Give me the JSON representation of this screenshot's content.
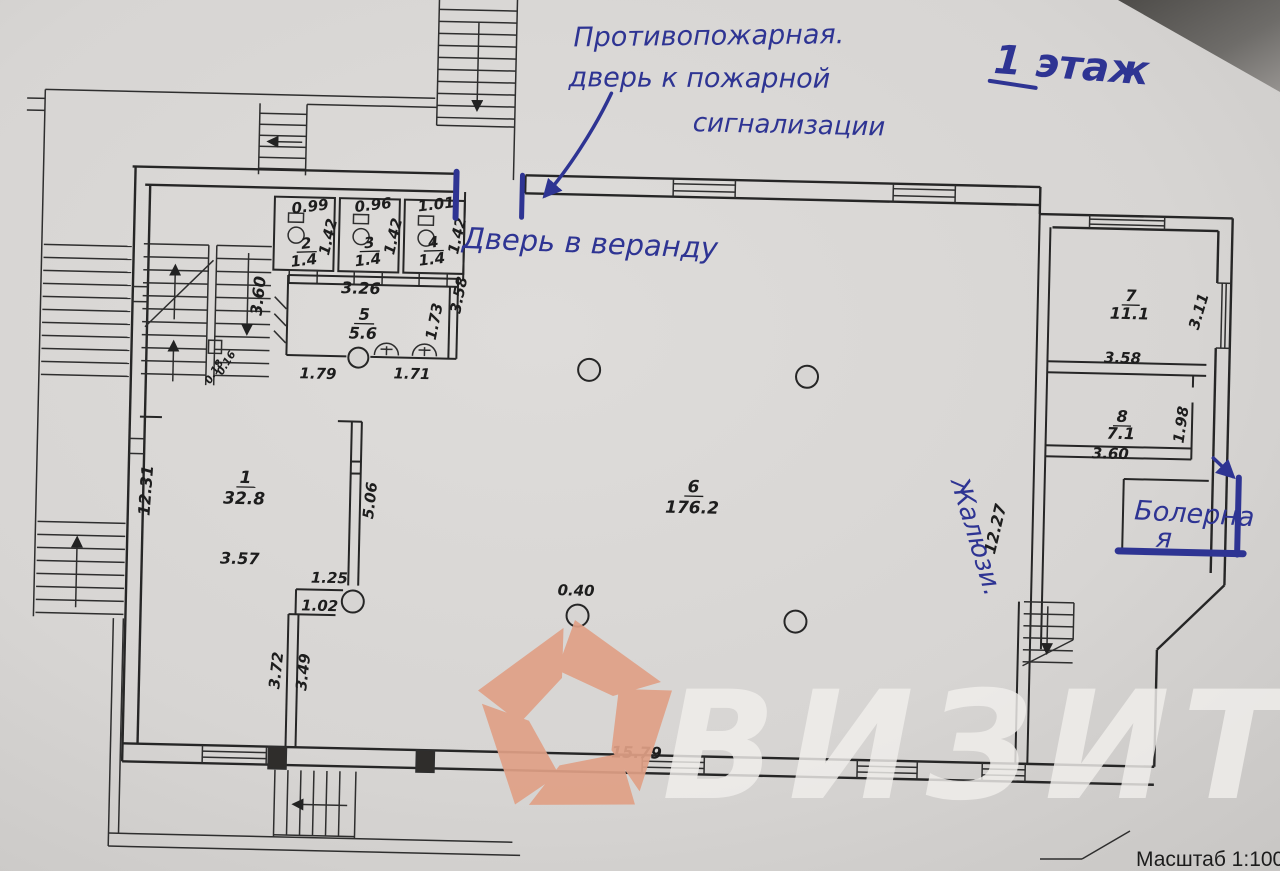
{
  "meta": {
    "floor_title": "1 этаж",
    "scale_label": "Масштаб 1:100"
  },
  "handwritten": {
    "ink_color": "#2e3493",
    "fire_note": [
      "Противопожарная.",
      "дверь к пожарной",
      "сигнализации"
    ],
    "veranda_note": "Дверь в веранду",
    "boiler_note": [
      "Болерна",
      "я"
    ],
    "blinds_note": "Жалюзи."
  },
  "watermark": {
    "brand": "ВИЗИТ",
    "logo_color": "#e0a086",
    "text_color": "#f1efec"
  },
  "rooms": {
    "r1": {
      "num": "1",
      "area": "32.8"
    },
    "r2": {
      "num": "2",
      "area": "1.4"
    },
    "r3": {
      "num": "3",
      "area": "1.4"
    },
    "r4": {
      "num": "4",
      "area": "1.4"
    },
    "r5": {
      "num": "5",
      "area": "5.6"
    },
    "r6": {
      "num": "6",
      "area": "176.2"
    },
    "r7": {
      "num": "7",
      "area": "11.1"
    },
    "r8": {
      "num": "8",
      "area": "7.1"
    }
  },
  "dims": {
    "w2": "0.99",
    "w3": "0.96",
    "w4": "1.01",
    "stall_depth": "1.42",
    "room5_top": "3.26",
    "room5_right": "1.73",
    "corridor_right": "3.58",
    "room5_b_left": "1.79",
    "room5_b_right": "1.71",
    "stair_width": "3.60",
    "col_a": "0.18",
    "col_b": "0.16",
    "left_len": "12.31",
    "room1_w": "3.57",
    "hall_left": "5.06",
    "niche_a": "1.25",
    "niche_b": "1.02",
    "column_d": "0.40",
    "hall_right": "12.27",
    "room7_w": "3.58",
    "room7_win": "3.11",
    "room8_w": "3.60",
    "room8_right": "1.98",
    "lower_a": "3.72",
    "lower_b": "3.49",
    "bottom_len": "15.79"
  }
}
